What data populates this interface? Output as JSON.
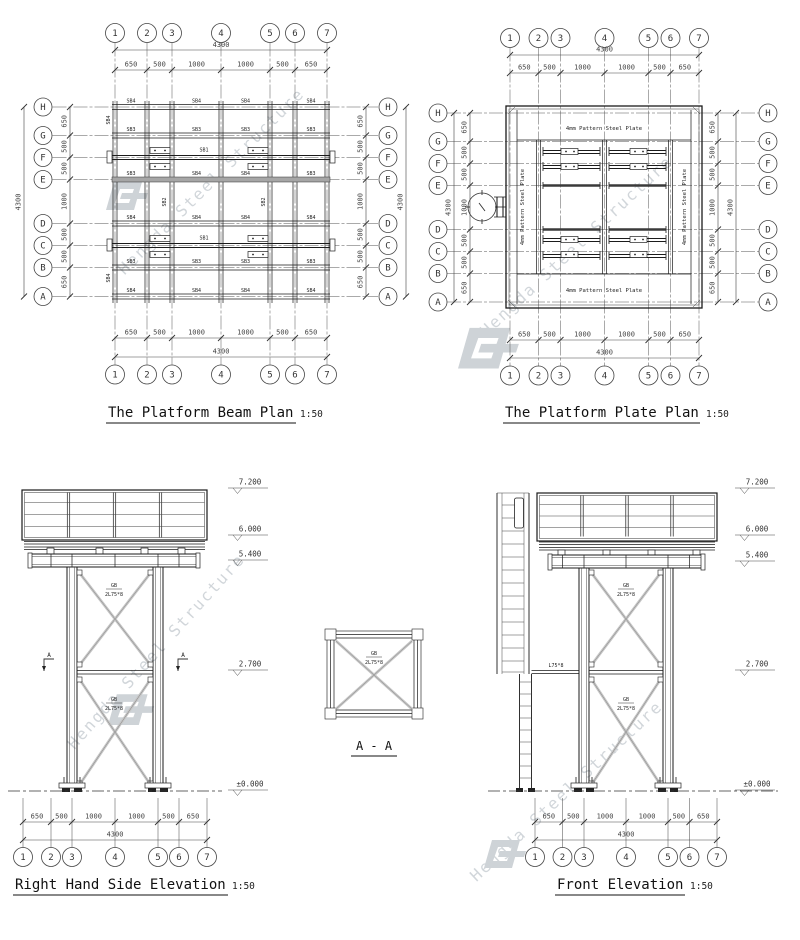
{
  "drawing": {
    "watermark_text": "Hengda Steel Structure",
    "axis_cols": [
      "1",
      "2",
      "3",
      "4",
      "5",
      "6",
      "7"
    ],
    "axis_rows": [
      "H",
      "G",
      "F",
      "E",
      "D",
      "C",
      "B",
      "A"
    ],
    "dim_total": "4300",
    "dims_horizontal": [
      "650",
      "500",
      "1000",
      "1000",
      "500",
      "650"
    ],
    "dims_vertical": [
      "650",
      "500",
      "500",
      "1000",
      "500",
      "500",
      "650"
    ],
    "levels": [
      "7.200",
      "6.000",
      "5.400",
      "2.700",
      "±0.000"
    ],
    "beam_labels": {
      "sb1": "SB1",
      "sb2": "SB2",
      "sb3": "SB3",
      "sb4": "SB4"
    },
    "brace_label": {
      "top": "GB",
      "bottom": "2L75*8"
    },
    "angle_label": "L75*8",
    "plate_label": "4mm Pattern Steel Plate",
    "scale": "1:50",
    "section_marker": "A",
    "titles": {
      "beam_plan": "The Platform Beam Plan",
      "plate_plan": "The Platform Plate Plan",
      "side_elevation": "Right Hand Side Elevation",
      "section": "A - A",
      "front_elevation": "Front Elevation"
    }
  }
}
